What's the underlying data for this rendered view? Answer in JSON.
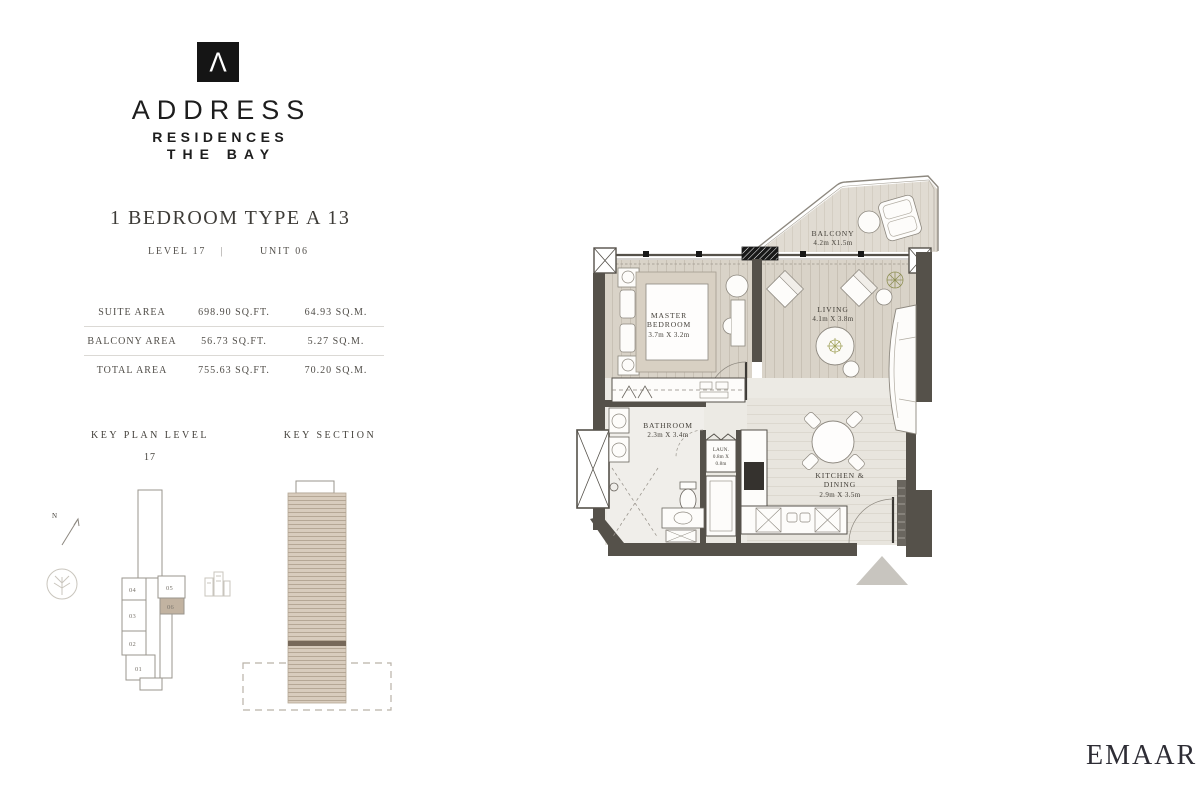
{
  "brand": {
    "logo_mark": "Λ",
    "name": "ADDRESS",
    "line1": "RESIDENCES",
    "line2": "THE BAY"
  },
  "plan_header": {
    "title": "1 BEDROOM TYPE A 13",
    "level": "LEVEL 17",
    "divider": "|",
    "unit": "UNIT 06"
  },
  "area_table": {
    "rows": [
      {
        "label": "SUITE AREA",
        "sqft": "698.90 SQ.FT.",
        "sqm": "64.93 SQ.M."
      },
      {
        "label": "BALCONY AREA",
        "sqft": "56.73 SQ.FT.",
        "sqm": "5.27 SQ.M."
      },
      {
        "label": "TOTAL AREA",
        "sqft": "755.63 SQ.FT.",
        "sqm": "70.20 SQ.M."
      }
    ]
  },
  "key_plan": {
    "title": "KEY PLAN LEVEL",
    "level": "17",
    "north": "N",
    "units": [
      "04",
      "05",
      "06",
      "03",
      "02",
      "01"
    ],
    "highlighted_unit": "06"
  },
  "key_section": {
    "title": "KEY SECTION"
  },
  "floor_plan": {
    "balcony": {
      "name": "BALCONY",
      "dims": "4.2m X1.5m"
    },
    "master_bedroom": {
      "line1": "MASTER",
      "line2": "BEDROOM",
      "dims": "3.7m X 3.2m"
    },
    "living": {
      "name": "LIVING",
      "dims": "4.1m X 3.8m"
    },
    "bathroom": {
      "name": "BATHROOM",
      "dims": "2.3m X 3.4m"
    },
    "laundry": {
      "name": "LAUN.",
      "dims_line1": "0.8m X",
      "dims_line2": "0.8m"
    },
    "kitchen_dining": {
      "line1": "KITCHEN &",
      "line2": "DINING",
      "dims": "2.9m X 3.5m"
    }
  },
  "footer": {
    "brand": "EMAAR"
  },
  "colors": {
    "wall": "#55514a",
    "wood_floor": "#d9d3c8",
    "light_floor": "#eae7e1",
    "balcony_floor": "#e0dbd2",
    "section_tan": "#d8ccbd",
    "unit_highlight": "#c2b3a1",
    "entry_arrow": "#c8c5bf",
    "ink": "#45423c"
  }
}
